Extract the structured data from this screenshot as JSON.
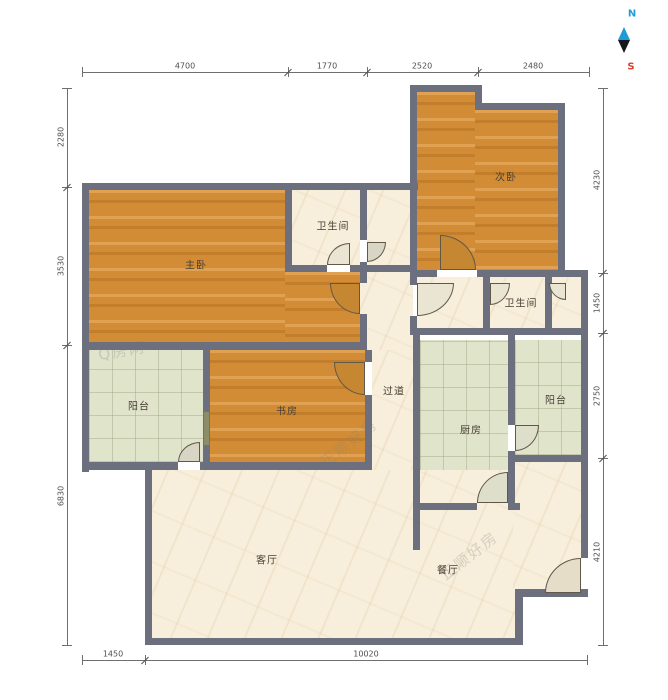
{
  "compass": {
    "north": "N",
    "south": "S",
    "north_color": "#1e9cd7",
    "south_color": "#e23b2e"
  },
  "rooms": {
    "master_bedroom": "主卧",
    "bathroom1": "卫生间",
    "second_bedroom": "次卧",
    "bathroom2": "卫生间",
    "hallway": "过道",
    "balcony_left": "阳台",
    "study": "书房",
    "kitchen": "厨房",
    "balcony_right": "阳台",
    "living_room": "客厅",
    "dining_room": "餐厅"
  },
  "dimensions": {
    "top": [
      "4700",
      "1770",
      "2520",
      "2480"
    ],
    "left": [
      "2280",
      "3530",
      "6830"
    ],
    "right": [
      "4230",
      "1450",
      "2750",
      "4210"
    ],
    "bottom": [
      "1450",
      "10020"
    ]
  },
  "watermarks": [
    "Q房网",
    "正顺好房"
  ],
  "colors": {
    "wall": "#6c6f7e",
    "wood_floor": "#d28c35",
    "marble_floor": "#f7eedb",
    "tile_floor": "#e0e4cb"
  }
}
